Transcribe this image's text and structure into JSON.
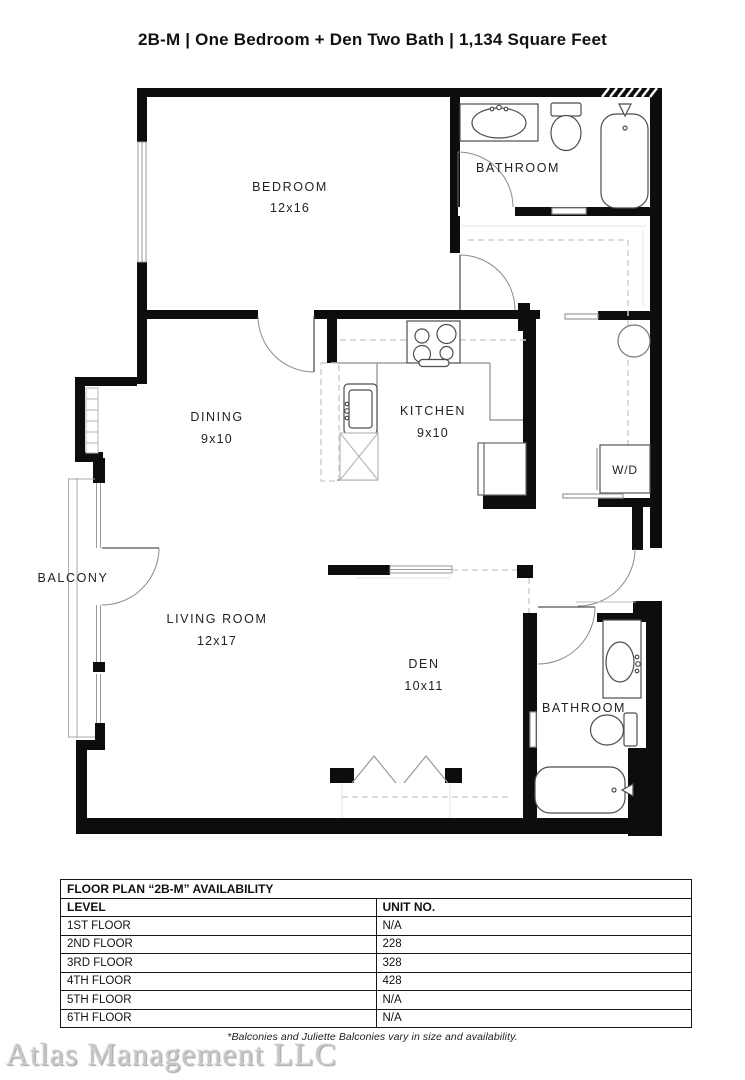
{
  "title": "2B-M | One Bedroom + Den Two Bath | 1,134  Square Feet",
  "plan": {
    "rooms": [
      {
        "name": "BEDROOM",
        "dims": "12x16"
      },
      {
        "name": "BATHROOM",
        "dims": ""
      },
      {
        "name": "DINING",
        "dims": "9x10"
      },
      {
        "name": "KITCHEN",
        "dims": "9x10"
      },
      {
        "name": "W/D",
        "dims": ""
      },
      {
        "name": "BALCONY",
        "dims": ""
      },
      {
        "name": "LIVING ROOM",
        "dims": "12x17"
      },
      {
        "name": "DEN",
        "dims": "10x11"
      },
      {
        "name": "BATHROOM",
        "dims": ""
      }
    ]
  },
  "availability_table": {
    "title": "FLOOR PLAN “2B-M” AVAILABILITY",
    "columns": [
      "LEVEL",
      "UNIT NO."
    ],
    "rows": [
      {
        "level": "1ST FLOOR",
        "unit": "N/A"
      },
      {
        "level": "2ND FLOOR",
        "unit": "228"
      },
      {
        "level": "3RD FLOOR",
        "unit": "328"
      },
      {
        "level": "4TH FLOOR",
        "unit": "428"
      },
      {
        "level": "5TH FLOOR",
        "unit": "N/A"
      },
      {
        "level": "6TH FLOOR",
        "unit": "N/A"
      }
    ]
  },
  "footnote": "*Balconies and Juliette Balconies vary in size and availability.",
  "watermark": "Atlas Management LLC"
}
